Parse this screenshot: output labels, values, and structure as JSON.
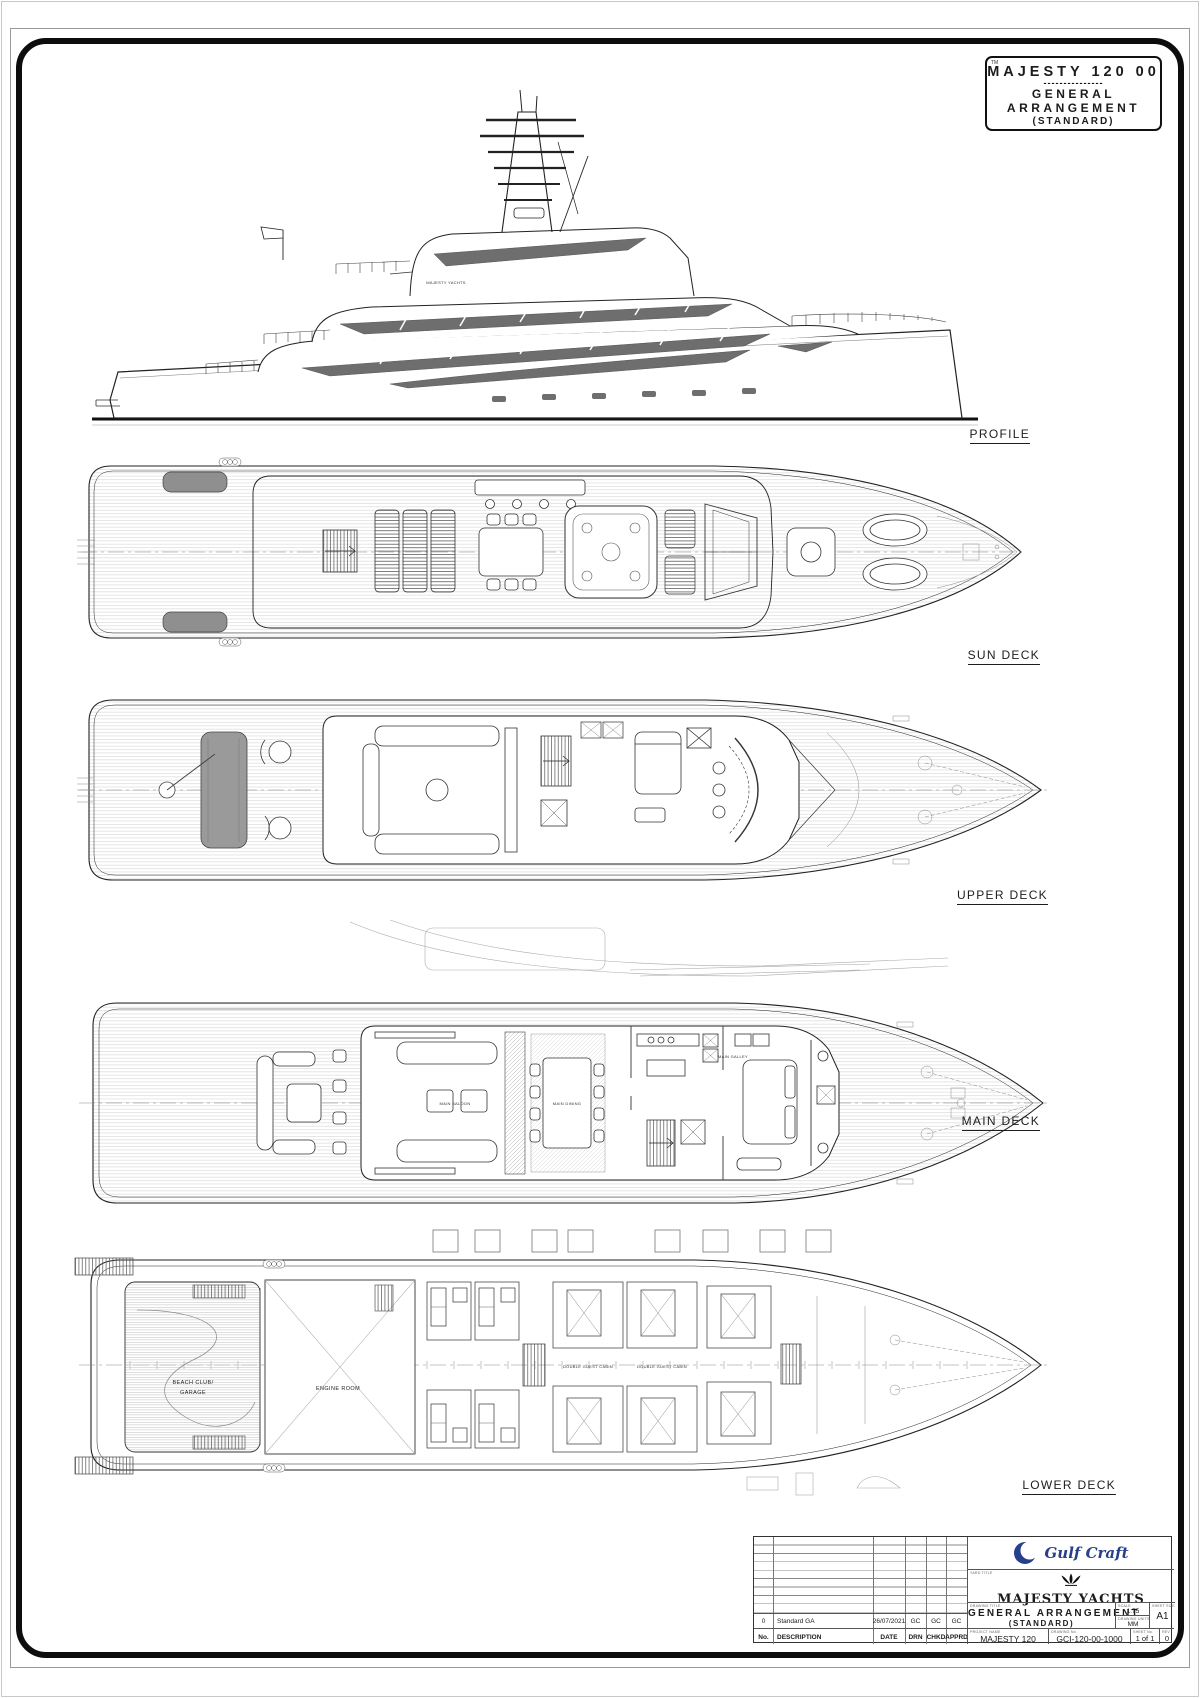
{
  "colors": {
    "navy": "#26408b",
    "line": "#1b1b1b",
    "glazing": "#6e6e6e"
  },
  "title_box": {
    "tm": "TM",
    "model": "MAJESTY 120 00",
    "divider": "---------------",
    "line1": "GENERAL",
    "line2": "ARRANGEMENT",
    "line3": "(STANDARD)"
  },
  "views": [
    {
      "label": "PROFILE"
    },
    {
      "label": "SUN DECK"
    },
    {
      "label": "UPPER DECK"
    },
    {
      "label": "MAIN DECK"
    },
    {
      "label": "LOWER DECK"
    }
  ],
  "rooms": {
    "main_saloon": "MAIN SALOON",
    "main_dining": "MAIN DINING",
    "main_galley": "MAIN GALLEY",
    "beach_club_1": "BEACH CLUB/",
    "beach_club_2": "GARAGE",
    "engine_room": "ENGINE ROOM",
    "guest_cabin": "DOUBLE GUEST CABIN",
    "brand_mark": "MAJESTY YACHTS"
  },
  "title_block": {
    "rev_headers": [
      "No.",
      "DESCRIPTION",
      "DATE",
      "DRN",
      "CHKD",
      "APPRD"
    ],
    "rev_row": {
      "no": "0",
      "description": "Standard GA",
      "date": "26/07/2021",
      "drn": "GC",
      "chkd": "GC",
      "apprd": "GC"
    },
    "brand": "Gulf Craft",
    "yard_title_label": "YARD TITLE",
    "yard_name": "MAJESTY YACHTS",
    "drawing_title_label": "DRAWING TITLE",
    "drawing_title": "GENERAL ARRANGEMENT",
    "drawing_subtitle": "(STANDARD)",
    "scale_label": "SCALE",
    "scale": "1:75",
    "units_label": "DRAWING UNITS",
    "units": "MM",
    "size_label": "SHEET SIZE",
    "size": "A1",
    "project_label": "PROJECT NAME",
    "project": "MAJESTY 120",
    "drawing_no_label": "DRAWING No.",
    "drawing_no": "GCI-120-00-1000",
    "sheet_label": "SHEET No.",
    "sheet": "1 of 1",
    "rev_label": "REV",
    "rev": "0"
  }
}
